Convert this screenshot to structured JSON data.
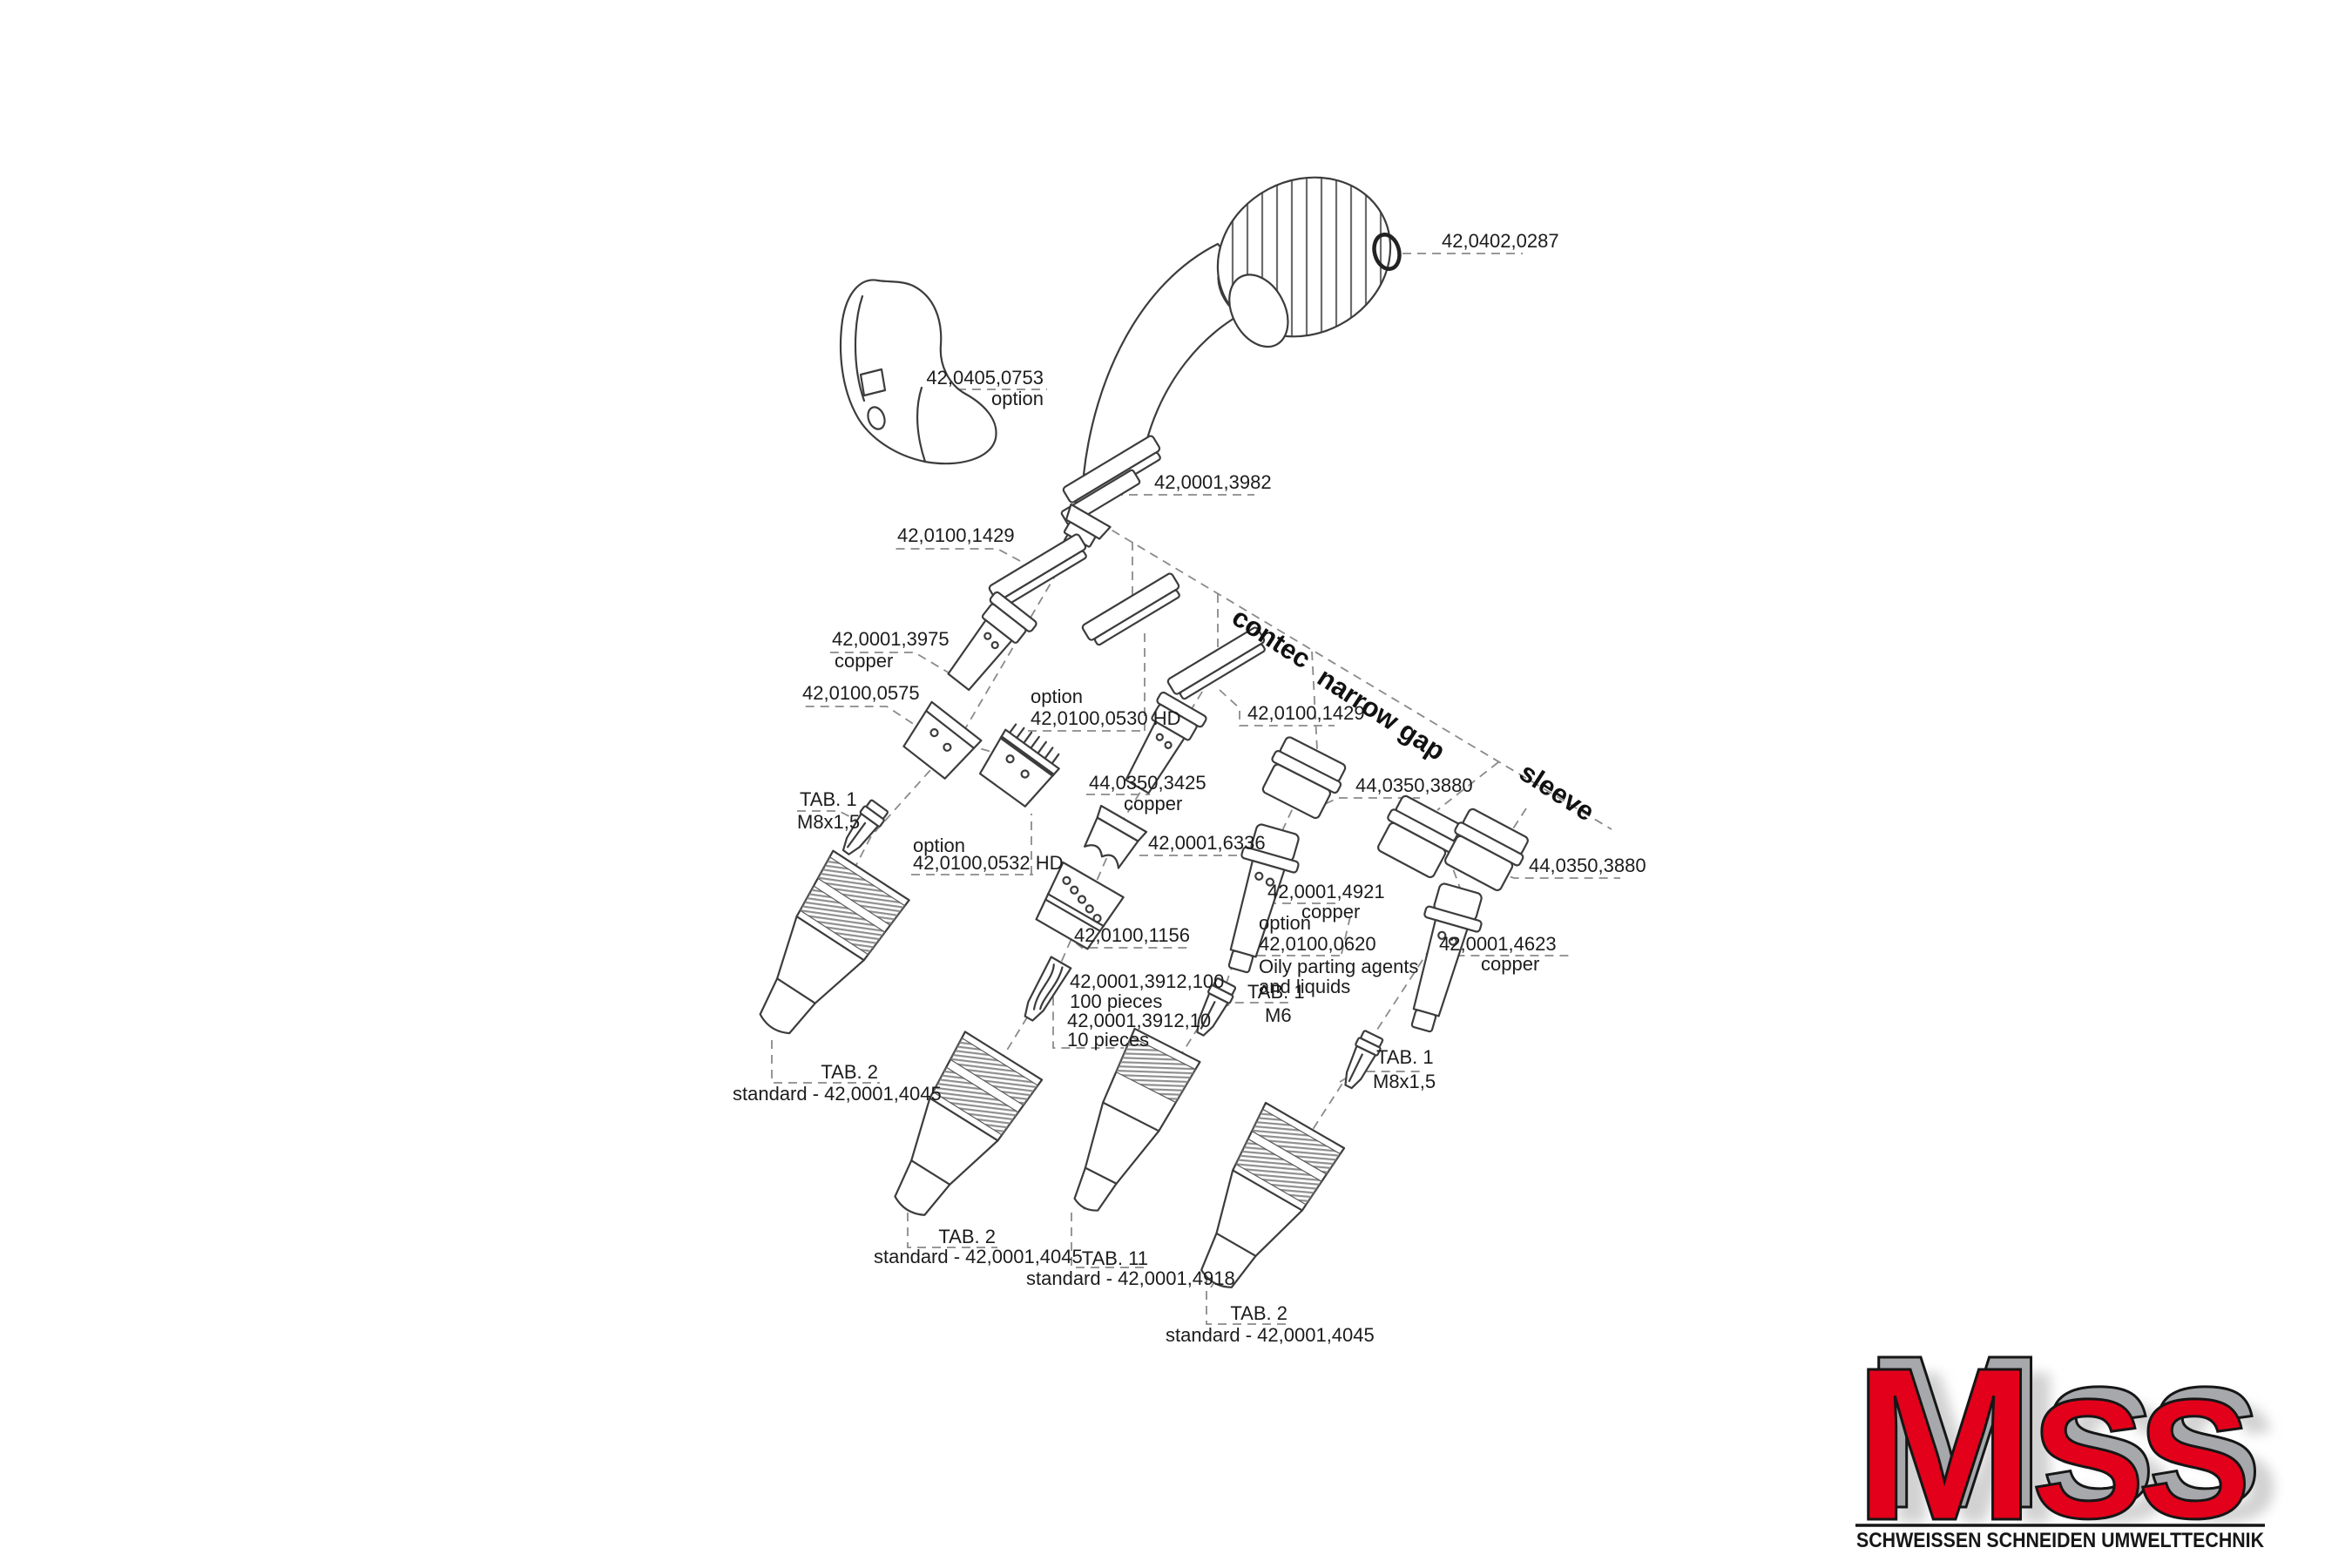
{
  "colors": {
    "line": "#3c3c3c",
    "dash_leader": "#8a8a8a",
    "text": "#1c1c1c",
    "hatch_gray": "#8f8f8f",
    "logo_red": "#e2001a",
    "logo_gray": "#a6a8ab"
  },
  "parts": {
    "oring": "42,0402,0287",
    "guard": "42,0405,0753",
    "option": "option",
    "neck": "42,0001,3982",
    "insulation_ring": "42,0100,1429",
    "tip_holder_std": "42,0001,3975",
    "copper": "copper",
    "gas_diffusor_std": "42,0100,0575",
    "gas_diffusor_hd_0530": "42,0100,0530 HD",
    "gas_diffusor_hd_0532": "42,0100,0532 HD",
    "tab1": "TAB. 1",
    "thread_m8": "M8x1,5",
    "thread_m6": "M6",
    "tip_holder_contec": "44,0350,3425",
    "spatter_guard": "42,0001,6336",
    "gas_diffusor_contec": "42,0100,1156",
    "contact_tip_100": "42,0001,3912,100",
    "qty_100": "100 pieces",
    "contact_tip_10": "42,0001,3912,10",
    "qty_10": "10 pieces",
    "sleeve_3880": "44,0350,3880",
    "tip_holder_narrow_gap": "42,0001,4921",
    "oily_option_part": "42,0100,0620",
    "oily_line1": "Oily parting agents",
    "oily_line2": "and liquids",
    "tip_holder_sleeve": "42,0001,4623",
    "tab2": "TAB. 2",
    "tab11": "TAB. 11",
    "nozzle_standard": "standard - 42,0001,4045",
    "nozzle_narrow_gap": "standard - 42,0001,4918"
  },
  "series": {
    "contec": "contec",
    "narrow_gap": "narrow gap",
    "sleeve": "sleeve"
  },
  "logo": {
    "m": "M",
    "ss": "SS",
    "tagline": "SCHWEISSEN SCHNEIDEN UMWELTTECHNIK"
  }
}
